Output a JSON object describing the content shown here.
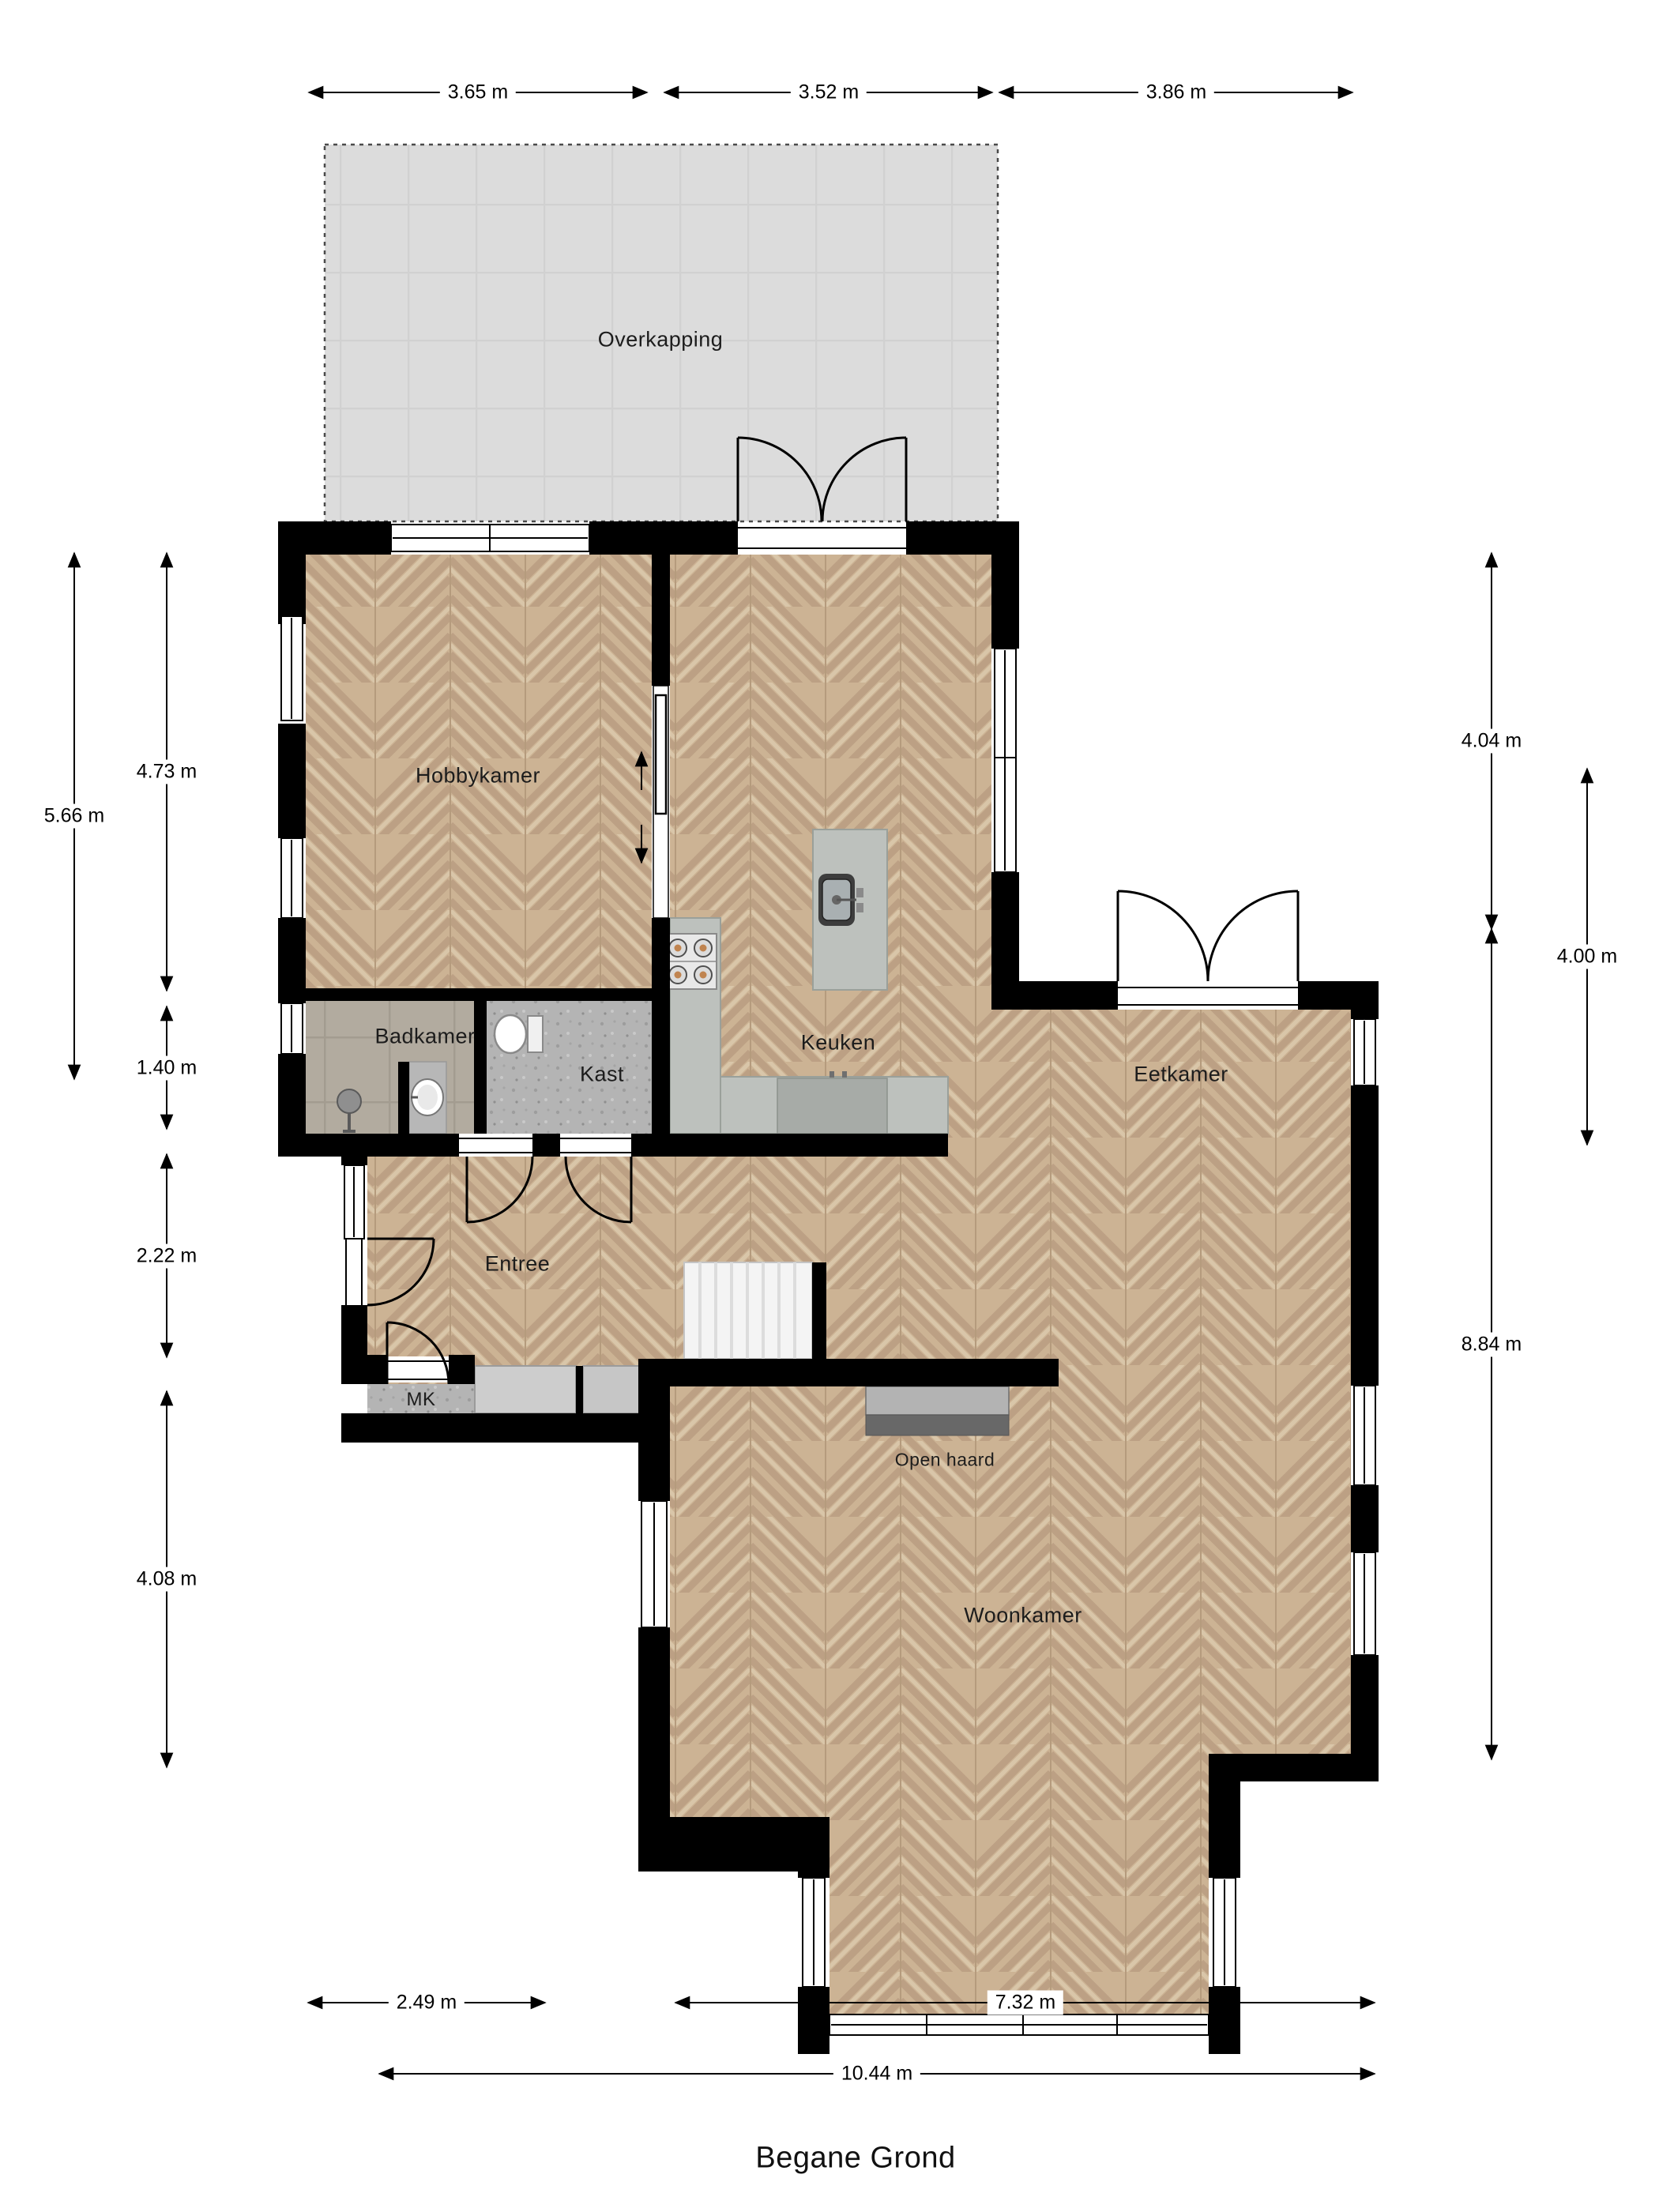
{
  "plan_title": "Begane Grond",
  "rooms": {
    "overkapping": "Overkapping",
    "hobbykamer": "Hobbykamer",
    "badkamer": "Badkamer",
    "kast": "Kast",
    "keuken": "Keuken",
    "eetkamer": "Eetkamer",
    "entree": "Entree",
    "mk": "MK",
    "open_haard": "Open haard",
    "woonkamer": "Woonkamer"
  },
  "dimensions": {
    "top": [
      "3.65 m",
      "3.52 m",
      "3.86 m"
    ],
    "left_outer": "5.66 m",
    "left_inner": [
      "4.73 m",
      "1.40 m",
      "2.22 m",
      "4.08 m"
    ],
    "right_col1": [
      "4.04 m",
      "8.84 m"
    ],
    "right_col2": "4.00 m",
    "bottom_row1": [
      "2.49 m",
      "7.32 m"
    ],
    "bottom_row2": "10.44 m"
  }
}
